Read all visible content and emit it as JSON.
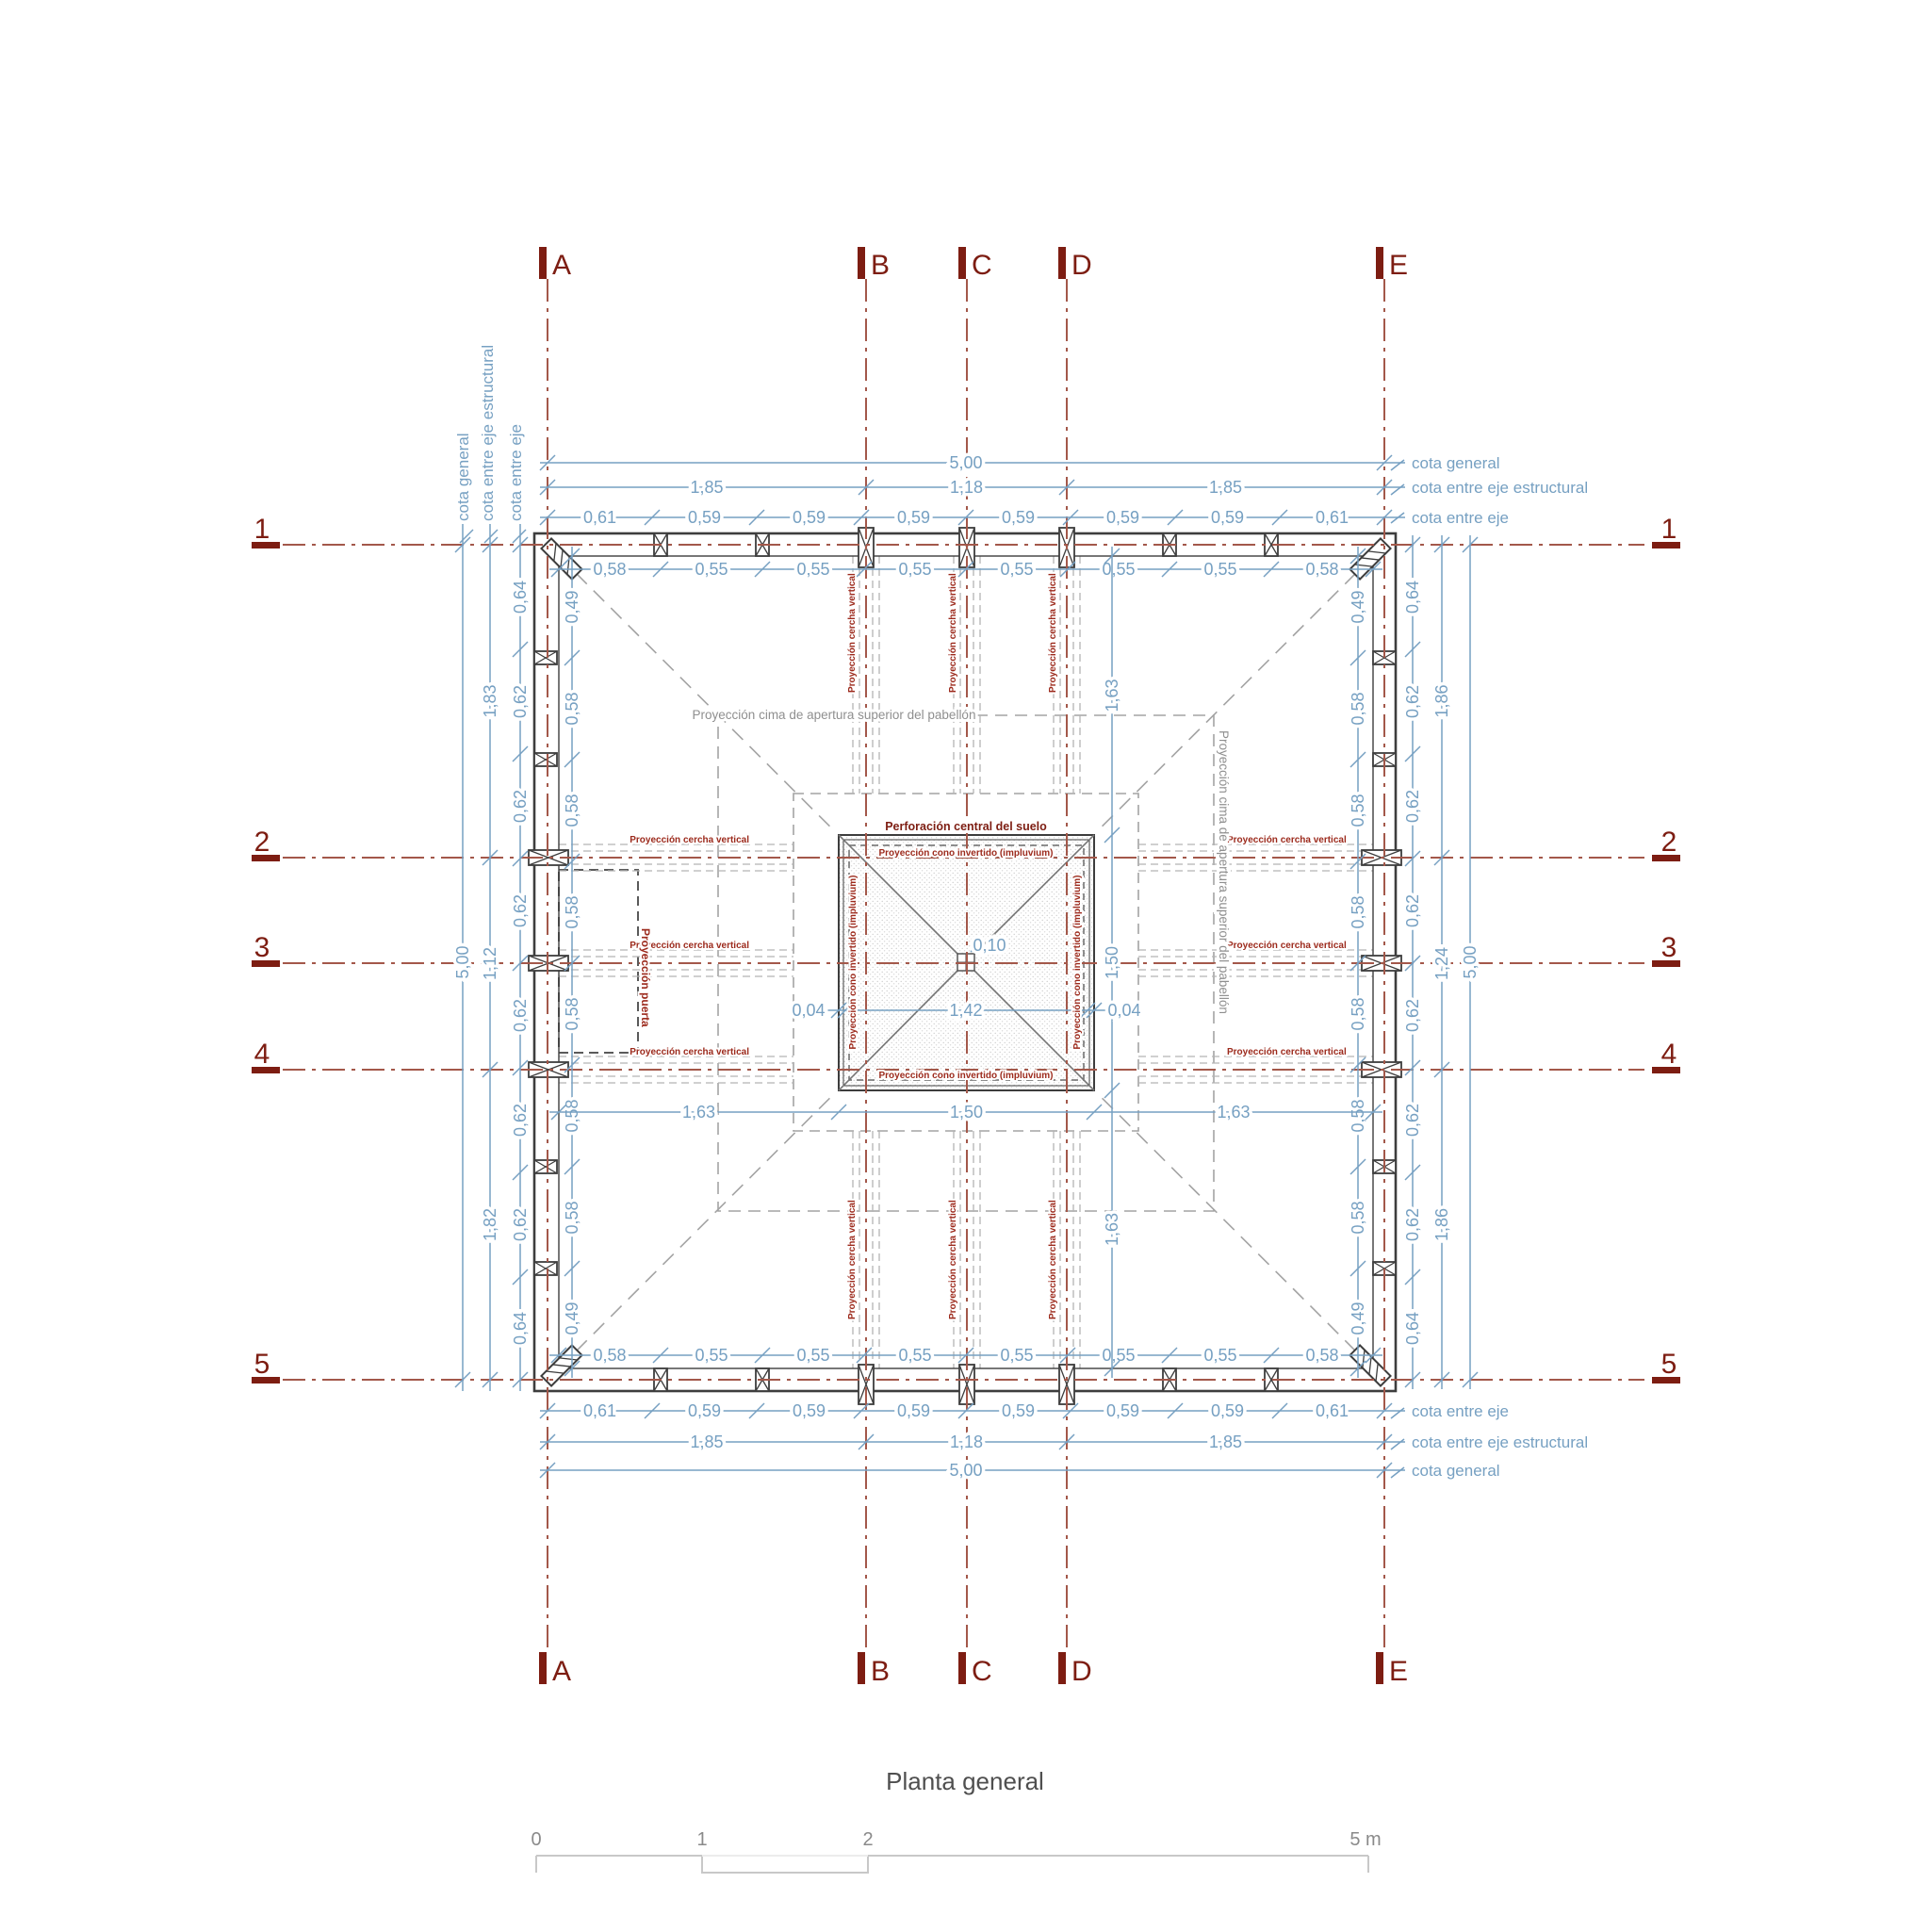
{
  "drawing": {
    "title": "Planta general",
    "grid": {
      "columns": [
        "A",
        "B",
        "C",
        "D",
        "E"
      ],
      "rows": [
        "1",
        "2",
        "3",
        "4",
        "5"
      ]
    },
    "cota_labels": {
      "general": "cota general",
      "estructural": "cota entre eje estructural",
      "eje": "cota entre eje"
    },
    "annotations": {
      "perforacion": "Perforación central del suelo",
      "cono": "Proyección cono invertido (impluvium)",
      "cercha": "Proyección cercha vertical",
      "cima": "Proyección cima de apertura superior del pabellón",
      "puerta": "Proyección puerta"
    },
    "dims": {
      "top_outer": "5,00",
      "top_struct": [
        "1,85",
        "1,18",
        "1,85"
      ],
      "top_axes": [
        "0,61",
        "0,59",
        "0,59",
        "0,59",
        "0,59",
        "0,59",
        "0,59",
        "0,61"
      ],
      "top_inner": [
        "0,58",
        "0,55",
        "0,55",
        "0,55",
        "0,55",
        "0,55",
        "0,55",
        "0,58"
      ],
      "bottom_inner": [
        "0,58",
        "0,55",
        "0,55",
        "0,55",
        "0,55",
        "0,55",
        "0,55",
        "0,58"
      ],
      "bottom_axes": [
        "0,61",
        "0,59",
        "0,59",
        "0,59",
        "0,59",
        "0,59",
        "0,59",
        "0,61"
      ],
      "bottom_struct": [
        "1,85",
        "1,18",
        "1,85"
      ],
      "bottom_outer": "5,00",
      "left_outer": "5,00",
      "left_struct": [
        "1,83",
        "1,12",
        "1,82"
      ],
      "left_axes": [
        "0,64",
        "0,62",
        "0,62",
        "0,62",
        "0,62",
        "0,62",
        "0,62",
        "0,64"
      ],
      "left_inner": [
        "0,49",
        "0,58",
        "0,58",
        "0,58",
        "0,58",
        "0,58",
        "0,58",
        "0,49"
      ],
      "right_inner": [
        "0,49",
        "0,58",
        "0,58",
        "0,58",
        "0,58",
        "0,58",
        "0,58",
        "0,49"
      ],
      "right_axes": [
        "0,64",
        "0,62",
        "0,62",
        "0,62",
        "0,62",
        "0,62",
        "0,62",
        "0,64"
      ],
      "right_struct": [
        "1,86",
        "1,24",
        "1,86"
      ],
      "right_outer": "5,00",
      "interior_h": [
        "1,63",
        "1,50",
        "1,63"
      ],
      "interior_v": [
        "1,63",
        "1,50",
        "1,63"
      ],
      "impluvium": [
        "0,04",
        "1,42",
        "0,04"
      ],
      "center_dim": "0,10"
    },
    "scale_bar": {
      "ticks": [
        "0",
        "1",
        "2"
      ],
      "end_label": "5 m"
    },
    "colors": {
      "dimension_blue": "#76a0c2",
      "axis_red": "#a3584a",
      "label_dark_red": "#7d1d12",
      "small_label_red": "#9c2a1c",
      "dashed_gray": "#a3a3a3",
      "wall_dark": "#3d3d3d",
      "text_gray": "#8f8f8f"
    }
  }
}
